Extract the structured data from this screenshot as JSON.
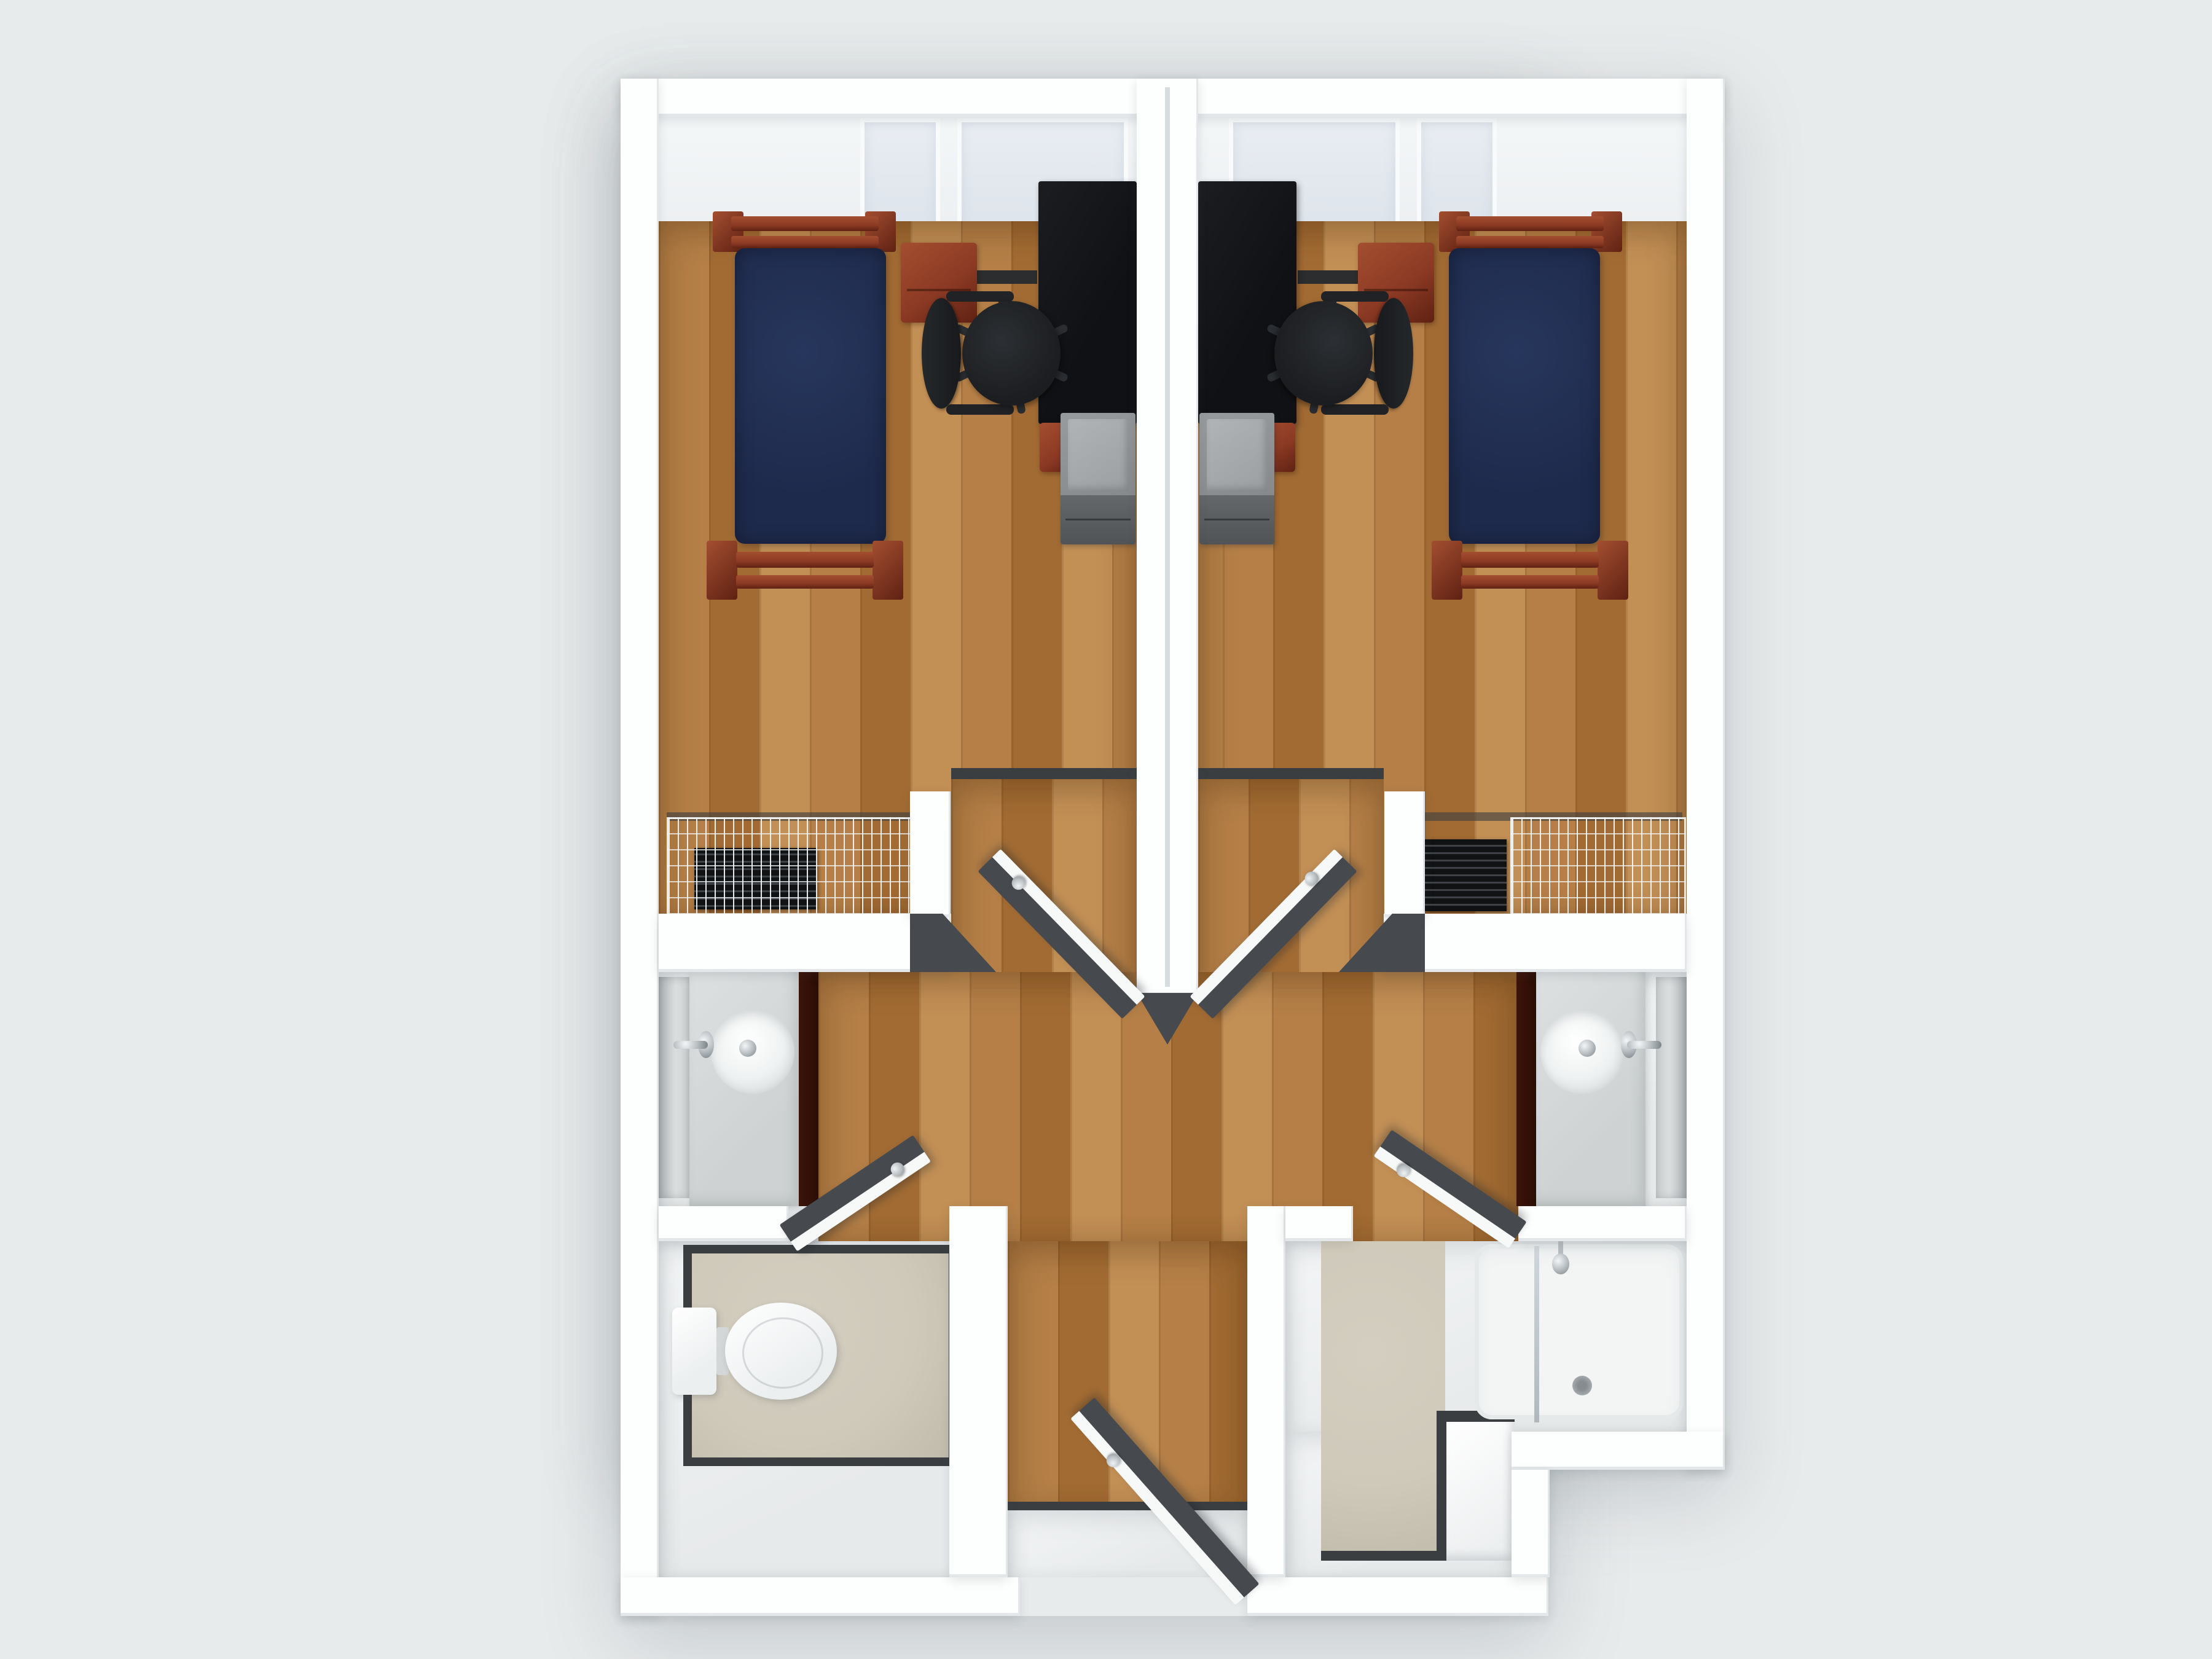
{
  "scene": {
    "type": "3d-floor-plan-render",
    "view": "top-down",
    "description": "Rendered overhead floor plan of a two-bedroom residence-hall suite with central hallway and split bathroom"
  },
  "rooms": [
    {
      "name": "Bedroom left",
      "floor": "hardwood"
    },
    {
      "name": "Bedroom right",
      "floor": "hardwood"
    },
    {
      "name": "Hallway",
      "floor": "hardwood"
    },
    {
      "name": "Vanity nook left",
      "floor": "painted"
    },
    {
      "name": "Vanity nook right",
      "floor": "painted"
    },
    {
      "name": "Toilet room",
      "floor": "beige tile"
    },
    {
      "name": "Shower room",
      "floor": "beige tile"
    },
    {
      "name": "Entry vestibule",
      "floor": "painted"
    }
  ],
  "fixtures": [
    "twin bed with navy mattress x2",
    "cherry bed frame x2",
    "cherry nightstand x2",
    "black desk x2",
    "black mesh office chair x2",
    "gray drawer pedestal x2",
    "closet wire shelf x2",
    "baseboard radiator x2",
    "round sink vanity x2",
    "wall mirror x2",
    "chrome faucet x2",
    "toilet",
    "shower tray with glass screen",
    "shower head",
    "tub step",
    "interior swing door x4",
    "entry door",
    "window pane x4"
  ],
  "palette": {
    "bg": "#e8ebec",
    "wall": "#fdfefe",
    "wall-face": "#f2f5f6",
    "wood-a": "#b57f47",
    "wood-b": "#a26b33",
    "wood-c": "#c28f55",
    "thresh": "#3a3e41",
    "door": "#46494d",
    "door-edge": "#f7f9f9",
    "navy": "#1e2a4c",
    "navy-hi": "#27365c",
    "cherry": "#8c3a24",
    "cherry-d": "#5f2113",
    "cherry-l": "#a34e30",
    "desk": "#141519",
    "chair": "#1b1d20",
    "gray-unit": "#8b8f91",
    "gray-top": "#a8acae",
    "gray-drawer": "#595d60",
    "rad": "#101214",
    "rad-line": "#3e4246",
    "tile": "#cfc9ba",
    "tile-d": "#c1bbac",
    "counter": "#d8dbdc",
    "mirror-a": "#adb2b4",
    "mirror-b": "#dbdedf",
    "chrome": "#c6cbce",
    "glass-a": "#e9edf3",
    "glass-b": "#dbe2e9",
    "wfloor": "#f0f2f3"
  }
}
